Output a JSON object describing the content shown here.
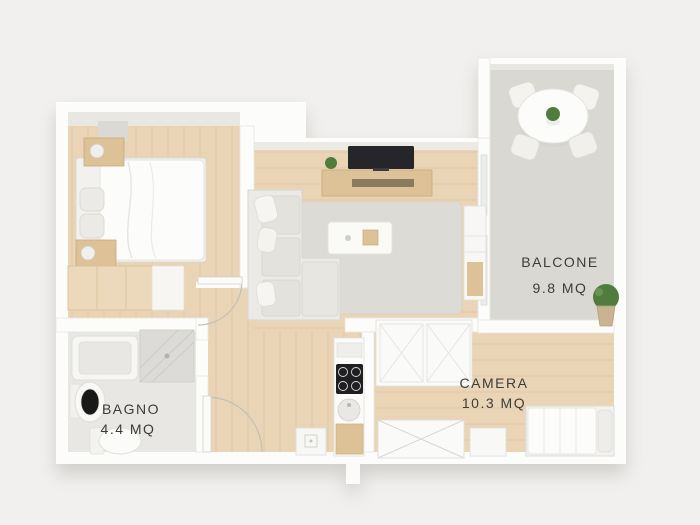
{
  "scene": {
    "description": "3D isometric floor plan render of a small apartment, viewed from above",
    "units": "MQ"
  },
  "labels": {
    "balcone": {
      "name": "BALCONE",
      "area": "9.8 MQ"
    },
    "camera": {
      "name": "CAMERA",
      "area": "10.3 MQ"
    },
    "bagno": {
      "name": "BAGNO",
      "area": "4.4 MQ"
    }
  },
  "colors": {
    "background": "#f1f0ee",
    "wall": "#fcfcfb",
    "wall_inner_face": "#e9e7e2",
    "wood_floor": "#e9d5b5",
    "balcony_floor": "#dad8d2",
    "bathroom_floor": "#e8e7e4",
    "rug": "#dcdbd6",
    "furniture_wood": "#ddc197",
    "furniture_white": "#f6f5f2",
    "tv_screen": "#26262a",
    "cooktop": "#1f1f21",
    "plant_green": "#507c3e",
    "label_text": "#3d3c39"
  },
  "furniture": {
    "bedroom": [
      "double bed with white duvet and pillows",
      "nightstand with lamp (top)",
      "nightstand with lamp (bottom)",
      "wood wardrobe dresser",
      "wall shelf"
    ],
    "living_area": [
      "L-shaped sofa with cushions",
      "white coffee table with wood tray",
      "TV on wood media console",
      "small potted plant",
      "gray area rug",
      "tall white cabinet"
    ],
    "kitchen": [
      "upper shelf",
      "black 4-burner cooktop",
      "round sink",
      "wood base cabinet",
      "appliance box"
    ],
    "camera": [
      "single bed with pillow",
      "white nightstand",
      "wardrobe with X doors",
      "closet unit"
    ],
    "bagno": [
      "bathtub",
      "glass shower",
      "pedestal washbasin",
      "toilet"
    ],
    "balcone": [
      "round white dining table",
      "four chairs",
      "table centerpiece plant",
      "potted plant"
    ]
  }
}
